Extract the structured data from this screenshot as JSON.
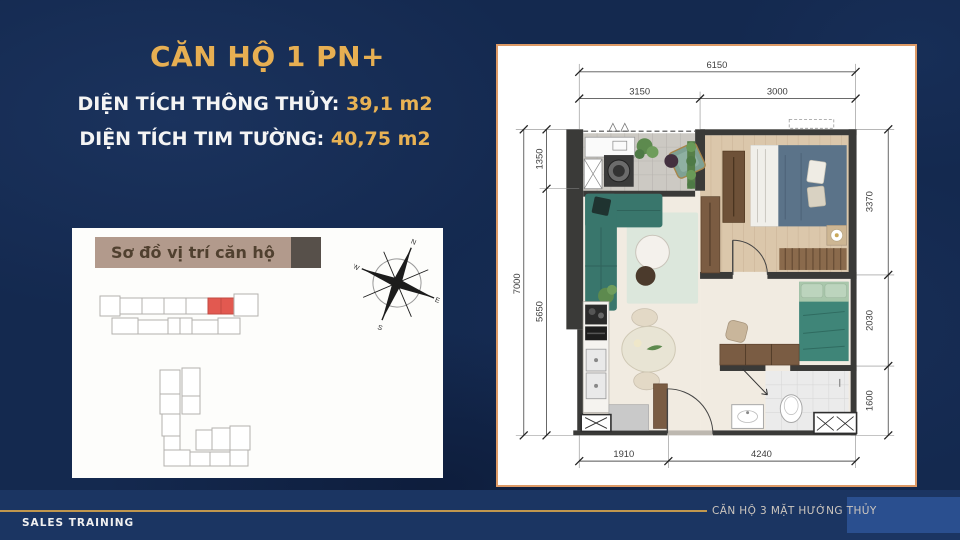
{
  "header": {
    "title": "CĂN HỘ 1 PN+",
    "line1_label": "DIỆN TÍCH THÔNG THỦY:",
    "line1_value": "39,1 m2",
    "line2_label": "DIỆN TÍCH TIM TƯỜNG:",
    "line2_value": "40,75 m2"
  },
  "location_box": {
    "title": "Sơ đồ vị trí căn hộ",
    "highlight_note": "red-unit-highlight"
  },
  "compass": {
    "n": "N",
    "e": "E",
    "s": "S",
    "w": "W"
  },
  "plan": {
    "dims": {
      "top_total": "6150",
      "top_left": "3150",
      "top_right": "3000",
      "left_total": "7000",
      "left_upper": "1350",
      "left_lower": "5650",
      "right_upper": "3370",
      "right_middle": "2030",
      "right_lower": "1600",
      "bottom_left": "1910",
      "bottom_right": "4240"
    }
  },
  "footer": {
    "left": "SALES TRAINING",
    "right": "CĂN HỘ 3 MẶT HƯỚNG THỦY"
  },
  "colors": {
    "accent_gold": "#E7AF52",
    "navy_background": "#14294F",
    "panel_border": "#DD9A66",
    "highlight_red": "#E25950",
    "header_tan": "#B29A8C",
    "footer_line_gold": "#C1974E"
  }
}
